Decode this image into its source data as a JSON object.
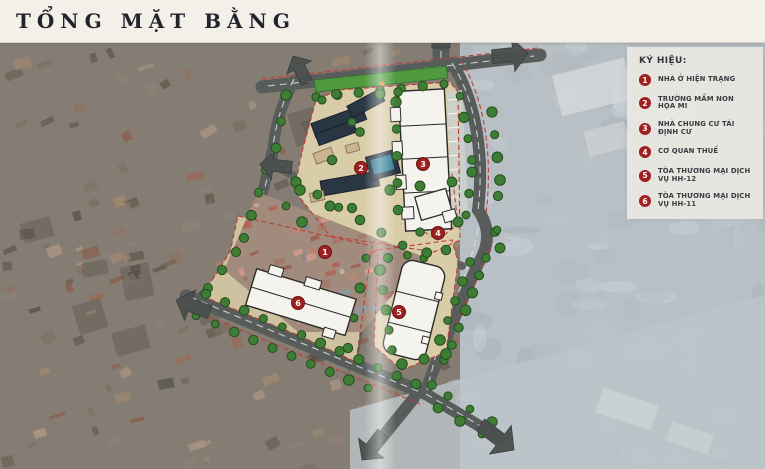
{
  "title": "TỔNG MẶT BẰNG",
  "legend": {
    "title": "KÝ HIỆU:",
    "items": [
      {
        "num": "1",
        "label": "NHÀ Ở HIỆN TRẠNG"
      },
      {
        "num": "2",
        "label": "TRƯỜNG MẦM NON HỌA MI"
      },
      {
        "num": "3",
        "label": "NHÀ CHUNG CƯ TÁI ĐỊNH CƯ"
      },
      {
        "num": "4",
        "label": "CƠ QUAN THUẾ"
      },
      {
        "num": "5",
        "label": "TÒA THƯƠNG MẠI DỊCH VỤ HH-12"
      },
      {
        "num": "6",
        "label": "TÒA THƯƠNG MẠI DỊCH VỤ HH-11"
      }
    ]
  },
  "map": {
    "markers": [
      {
        "num": "1",
        "x": 325,
        "y": 252
      },
      {
        "num": "2",
        "x": 361,
        "y": 168
      },
      {
        "num": "3",
        "x": 423,
        "y": 164
      },
      {
        "num": "4",
        "x": 438,
        "y": 233
      },
      {
        "num": "5",
        "x": 399,
        "y": 312
      },
      {
        "num": "6",
        "x": 298,
        "y": 303
      }
    ]
  },
  "colors": {
    "marker_red": "#9e2020",
    "boundary_red": "#c23b32",
    "road_gray": "#585d5c",
    "parcel_tan": "#d9cca8",
    "lawn_green": "#4f9a3f",
    "tree_green": "#3e7e34",
    "building_navy": "#2a3644",
    "building_white": "#f5f3ee"
  }
}
